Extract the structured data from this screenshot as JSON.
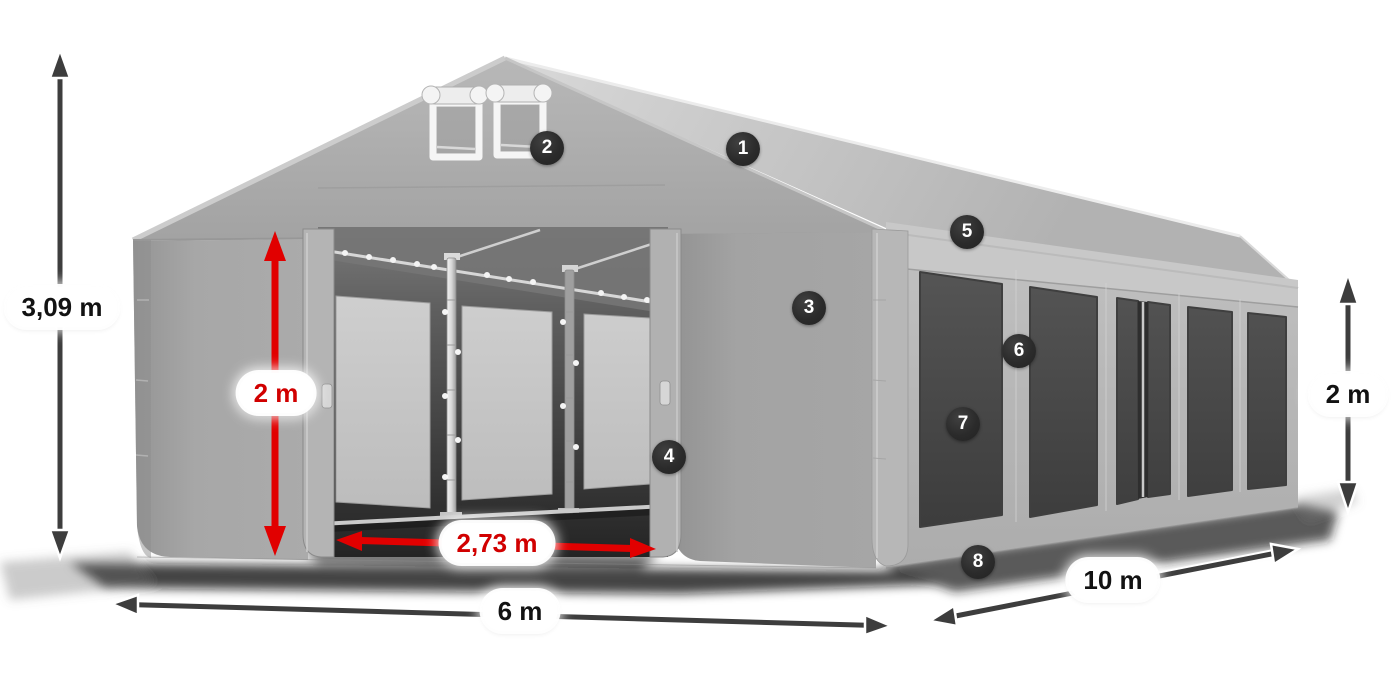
{
  "diagram": {
    "kind": "tent-dimension-illustration",
    "dimension_labels": {
      "total_height": "3,09 m",
      "door_height": "2 m",
      "door_width": "2,73 m",
      "front_width": "6 m",
      "side_length": "10 m",
      "side_wall_height": "2 m"
    },
    "markers": [
      {
        "number": "1"
      },
      {
        "number": "2"
      },
      {
        "number": "3"
      },
      {
        "number": "4"
      },
      {
        "number": "5"
      },
      {
        "number": "6"
      },
      {
        "number": "7"
      },
      {
        "number": "8"
      }
    ],
    "colors": {
      "background": "#ffffff",
      "tent_light_gray": "#c8c8c8",
      "tent_mid_gray": "#a6a6a6",
      "tent_dark_gray": "#8f8f8f",
      "window_dark": "#484848",
      "marker_background": "#2a2a2a",
      "marker_text": "#ffffff",
      "dimension_arrow_dark": "#3d3d3d",
      "dimension_arrow_red": "#e10000",
      "label_background": "#ffffff",
      "label_text_dark": "#121212",
      "label_text_red": "#d10000"
    }
  }
}
